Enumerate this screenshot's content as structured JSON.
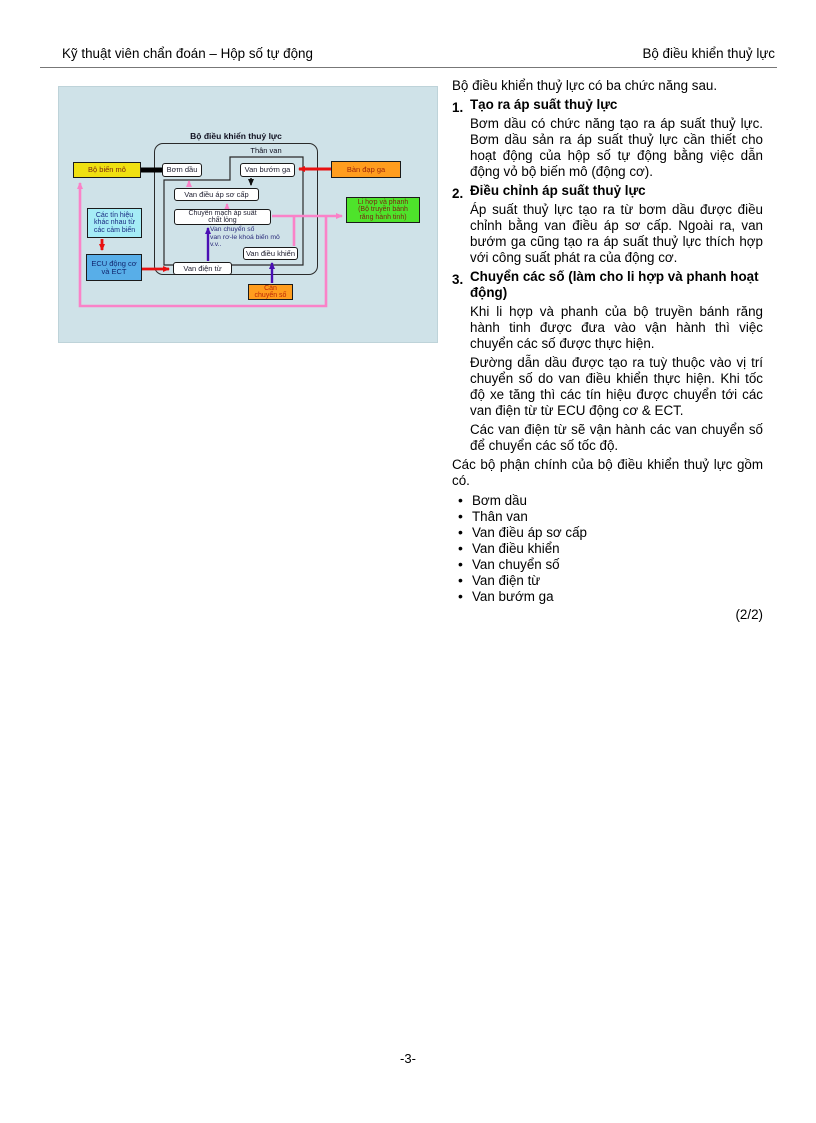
{
  "page": {
    "header_left": "Kỹ thuật viên chẩn đoán – Hộp số tự động",
    "header_right": "Bộ điều khiển thuỷ lực",
    "footer_page_number": "-3-",
    "page_indicator": "(2/2)"
  },
  "diagram": {
    "title": "Bộ điều khiển thuỷ lực",
    "valve_body_label": "Thân van",
    "boxes": {
      "torque_converter": "Bộ biến mô",
      "oil_pump": "Bơm dầu",
      "throttle_valve": "Van bướm ga",
      "accelerator_pedal": "Bàn đạp ga",
      "primary_regulator_valve": "Van điều áp sơ cấp",
      "fluid_pressure_switch": [
        "Chuyển mạch áp suất",
        "chất lỏng"
      ],
      "clutches_brakes": [
        "Li hợp và phanh",
        "(Bộ truyền bánh",
        "răng hành tinh)"
      ],
      "sensor_signals": [
        "Các tín hiệu",
        "khác nhau từ",
        "các cảm biến"
      ],
      "ecu": [
        "ECU động cơ",
        "và ECT"
      ],
      "control_valve": "Van điều khiển",
      "solenoid_valve": "Van điện từ",
      "shift_lever": [
        "Cần",
        "chuyển số"
      ]
    },
    "annotation": [
      "Van chuyển số",
      "van rơ-le khoá biến mô",
      "v.v.."
    ],
    "colors": {
      "panel_bg": "#cfe2e8",
      "yellow_box": "#f0e011",
      "orange_box": "#ff9d1e",
      "green_box": "#4ee32b",
      "cyan_box": "#a5ecf6",
      "blue_box": "#58aee8",
      "white_box": "#ffffff",
      "pink_line": "#fa82c8",
      "red_line": "#e81010",
      "purple_line": "#4a0fb4",
      "black_line": "#000000"
    }
  },
  "content": {
    "intro": "Bộ điều khiển thuỷ lực có ba chức năng sau.",
    "sections": [
      {
        "num": "1.",
        "heading": "Tạo ra áp suất thuỷ lực",
        "paragraphs": [
          "Bơm dầu có chức năng tạo ra áp suất thuỷ lực. Bơm dầu sản ra áp suất thuỷ lực cần thiết cho hoạt động của hộp số tự động bằng việc dẫn động vỏ bộ biến mô (động cơ)."
        ]
      },
      {
        "num": "2.",
        "heading": "Điều chỉnh áp suất thuỷ lực",
        "paragraphs": [
          "Áp suất thuỷ lực tạo ra từ bơm dầu được điều chỉnh bằng van điều áp sơ cấp. Ngoài ra, van bướm ga cũng tạo ra áp suất thuỷ lực thích hợp với công suất phát ra của động cơ."
        ]
      },
      {
        "num": "3.",
        "heading": "Chuyển các số (làm cho li hợp và phanh hoạt động)",
        "paragraphs": [
          "Khi li hợp và phanh của bộ truyền bánh răng hành tinh được đưa vào vận hành thì việc chuyển các số được thực hiện.",
          "Đường dẫn dầu được tạo ra tuỳ thuộc vào vị trí chuyển số do van điều khiển thực hiện. Khi tốc độ xe tăng thì các tín hiệu được chuyển tới các van điện từ từ ECU động cơ & ECT.",
          "Các van điện từ sẽ vận hành các van chuyển số để chuyển các số tốc độ."
        ]
      }
    ],
    "closing": "Các bộ phận chính của bộ điều khiển thuỷ lực gồm có.",
    "bullets": [
      "Bơm dầu",
      "Thân van",
      "Van điều áp sơ cấp",
      "Van điều khiển",
      "Van chuyển số",
      "Van điện từ",
      "Van bướm ga"
    ]
  }
}
